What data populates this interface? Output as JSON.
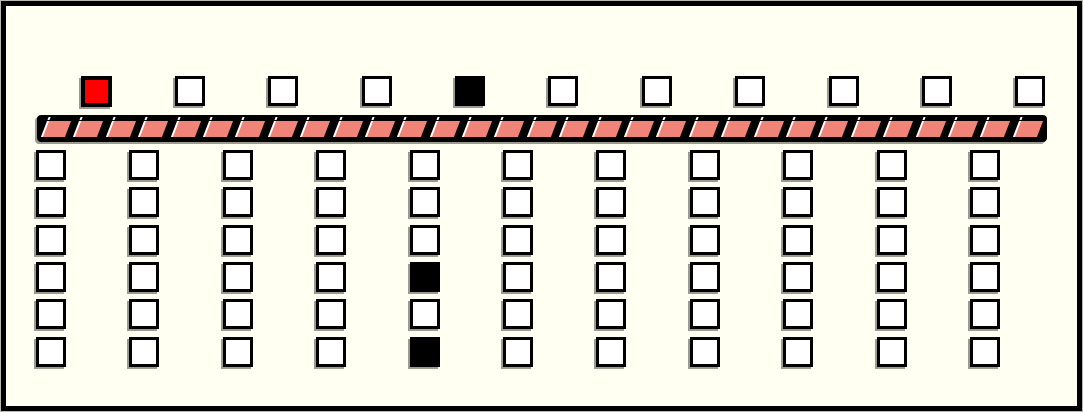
{
  "panel": {
    "description": "machine panel with hopper row, conveyor belt and bin grid"
  },
  "colors": {
    "page_background": "#FFFFFF",
    "panel_background": "#FFFFF2",
    "frame_border": "#000000",
    "cell_fill": "#FFFFFF",
    "cell_border": "#000000",
    "cell_filled": "#000000",
    "cell_selected": "#FF0000",
    "belt_band": "#000000",
    "belt_segment": "#F08478",
    "belt_highlight": "#FFFFFF",
    "shadow": "#9B9B93"
  },
  "hopper_row": {
    "count": 11,
    "states": [
      "selected",
      "empty",
      "empty",
      "empty",
      "filled",
      "empty",
      "empty",
      "empty",
      "empty",
      "empty",
      "empty"
    ]
  },
  "belt": {
    "segment_count": 31
  },
  "bin_grid": {
    "rows": 6,
    "cols": 11,
    "filled": [
      {
        "row": 4,
        "col": 5
      },
      {
        "row": 6,
        "col": 5
      }
    ]
  }
}
